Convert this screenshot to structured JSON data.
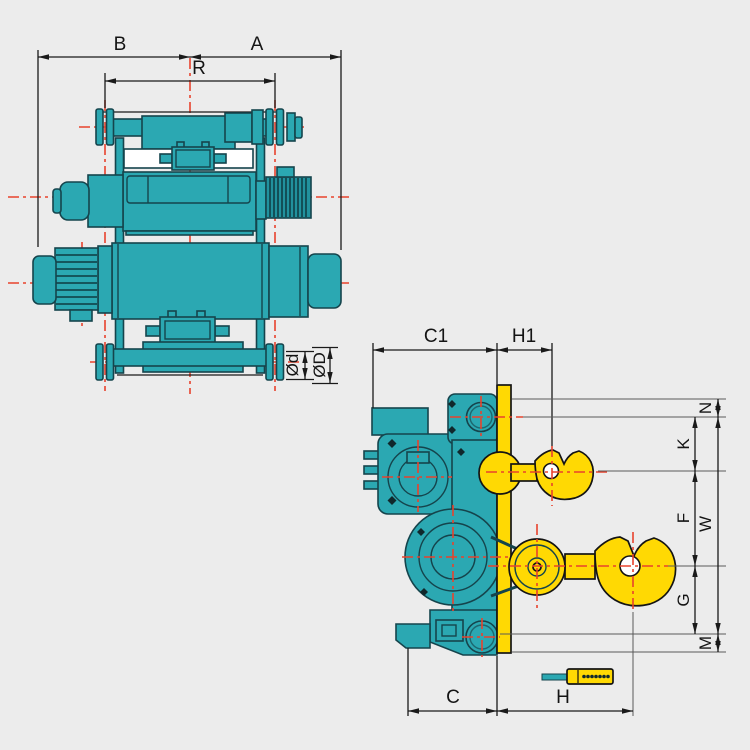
{
  "drawing": {
    "subject": "electric-wire-rope-hoist-dimension-drawing",
    "colors": {
      "background": "#ececec",
      "body_teal": "#2ba8b2",
      "outline_dark": "#15444c",
      "hook_yellow": "#ffd903",
      "centerline_red": "#e8432d",
      "dimension_line": "#1a1a1a"
    },
    "front_view": {
      "labels": {
        "b": "B",
        "a": "A",
        "r": "R",
        "wheel_tread_dia": "Ød",
        "wheel_flange_dia": "ØD"
      }
    },
    "side_view": {
      "labels": {
        "c1": "C1",
        "h1": "H1",
        "n": "N",
        "k": "K",
        "f": "F",
        "w": "W",
        "g": "G",
        "m": "M",
        "c": "C",
        "h": "H"
      }
    }
  }
}
